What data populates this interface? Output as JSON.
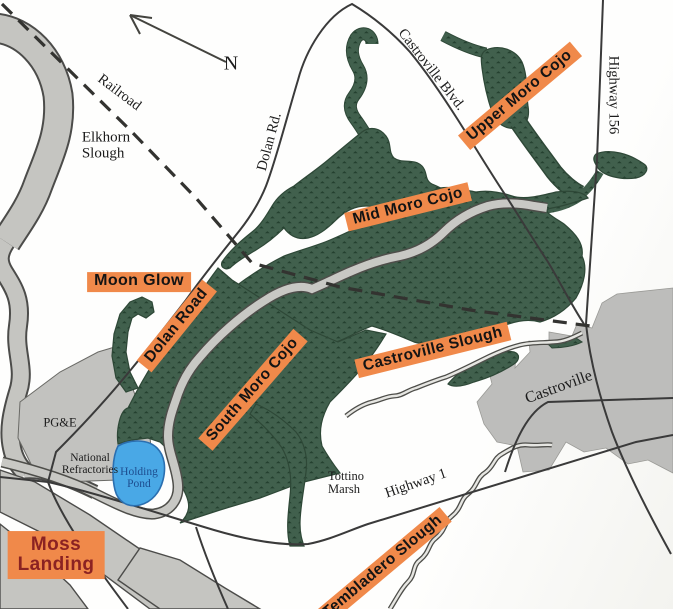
{
  "colors": {
    "highlight_bg": "#F0894A",
    "moss_landing_text": "#8B2222",
    "marsh_green": "#41604D",
    "marsh_speckle": "#24402F",
    "water_gray": "#C5C5C1",
    "urban_gray": "#BDBDBB",
    "pond_blue": "#49A8E6",
    "pond_text": "#1D4D8F",
    "road": "#3A3A3A"
  },
  "compass": {
    "north": "N"
  },
  "map_labels": {
    "railroad": "Railroad",
    "elkhorn_line1": "Elkhorn",
    "elkhorn_line2": "Slough",
    "dolan_rd": "Dolan Rd.",
    "castroville_blvd": "Castroville Blvd.",
    "highway_156": "Highway 156",
    "pge": "PG&E",
    "national_refractories_line1": "National",
    "national_refractories_line2": "Refractories",
    "holding_pond_line1": "Holding",
    "holding_pond_line2": "Pond",
    "tottino_marsh_line1": "Tottino",
    "tottino_marsh_line2": "Marsh",
    "highway_1": "Highway 1",
    "castroville_town": "Castroville"
  },
  "site_labels": {
    "upper_moro_cojo": "Upper Moro Cojo",
    "mid_moro_cojo": "Mid Moro Cojo",
    "moon_glow": "Moon Glow",
    "dolan_road": "Dolan Road",
    "south_moro_cojo": "South Moro Cojo",
    "castroville_slough": "Castroville Slough",
    "moss_landing_line1": "Moss",
    "moss_landing_line2": "Landing",
    "tembladero_slough": "Tembladero Slough"
  }
}
